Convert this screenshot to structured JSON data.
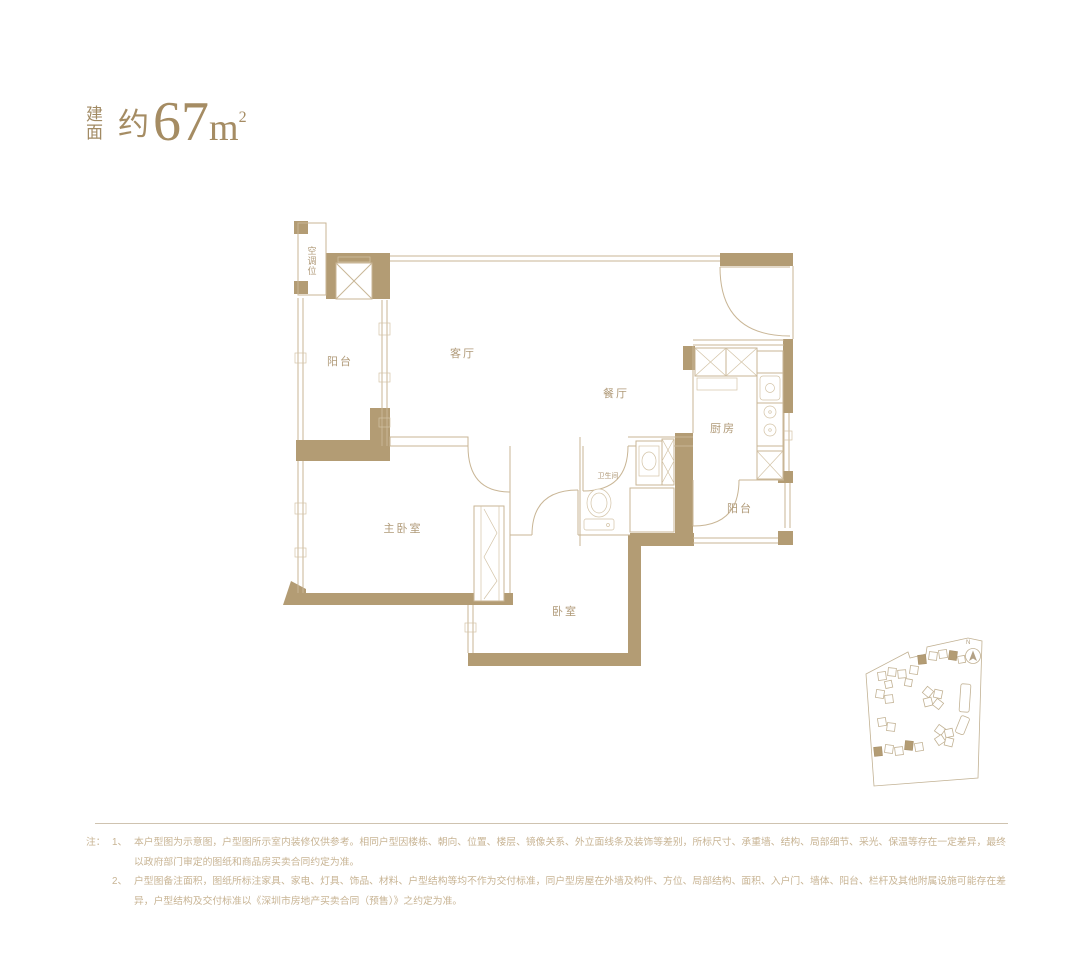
{
  "title": {
    "stack_top": "建",
    "stack_bottom": "面",
    "approx": "约",
    "number": "67",
    "unit_base": "m",
    "unit_exp": "2"
  },
  "floor_plan": {
    "rooms": [
      {
        "id": "ac-slot",
        "label": "空调位"
      },
      {
        "id": "balcony-left",
        "label": "阳台"
      },
      {
        "id": "living-room",
        "label": "客厅"
      },
      {
        "id": "dining-room",
        "label": "餐厅"
      },
      {
        "id": "kitchen",
        "label": "厨房"
      },
      {
        "id": "bathroom",
        "label": "卫生间"
      },
      {
        "id": "balcony-right",
        "label": "阳台"
      },
      {
        "id": "master-bedroom",
        "label": "主卧室"
      },
      {
        "id": "bedroom",
        "label": "卧室"
      }
    ],
    "colors": {
      "wall": "#b39c74",
      "line": "#c9b696",
      "label": "#b09a78"
    }
  },
  "site_plan": {
    "north_label": "N"
  },
  "notes": {
    "prefix": "注：",
    "items": [
      {
        "no": "1、",
        "text": "本户型图为示意图，户型图所示室内装修仅供参考。相同户型因楼栋、朝向、位置、楼层、镜像关系、外立面线条及装饰等差别，所标尺寸、承重墙、结构、局部细节、采光、保温等存在一定差异，最终以政府部门审定的图纸和商品房买卖合同约定为准。"
      },
      {
        "no": "2、",
        "text": "户型图备注面积，图纸所标注家具、家电、灯具、饰品、材料、户型结构等均不作为交付标准，同户型房屋在外墙及构件、方位、局部结构、面积、入户门、墙体、阳台、栏杆及其他附属设施可能存在差异，户型结构及交付标准以《深圳市房地产买卖合同（预售）》之约定为准。"
      }
    ]
  }
}
